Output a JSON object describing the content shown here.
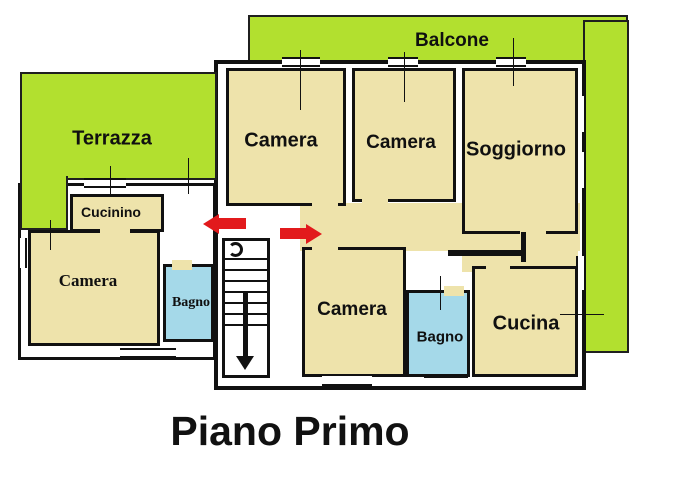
{
  "plan_title": "Piano Primo",
  "colors": {
    "outdoor_green": "#b2e02f",
    "room_tan": "#eee3ab",
    "bathroom_blue": "#a5d9e9",
    "wall_black": "#111111",
    "entrance_arrow_red": "#e21a1c"
  },
  "outdoor_areas": {
    "balcone": {
      "label": "Balcone"
    },
    "terrazza": {
      "label": "Terrazza"
    }
  },
  "rooms": {
    "camera_nw": {
      "label": "Camera"
    },
    "camera_n": {
      "label": "Camera"
    },
    "soggiorno": {
      "label": "Soggiorno"
    },
    "cucinino": {
      "label": "Cucinino"
    },
    "camera_w": {
      "label": "Camera"
    },
    "bagno_w": {
      "label": "Bagno"
    },
    "camera_s": {
      "label": "Camera"
    },
    "bagno_s": {
      "label": "Bagno"
    },
    "cucina": {
      "label": "Cucina"
    }
  },
  "icons": {
    "entrance_arrow_left": "red-arrow-left",
    "entrance_arrow_right": "red-arrow-right",
    "staircase": "stairs-with-down-arrow",
    "stair_spiral": "winder-spiral"
  }
}
